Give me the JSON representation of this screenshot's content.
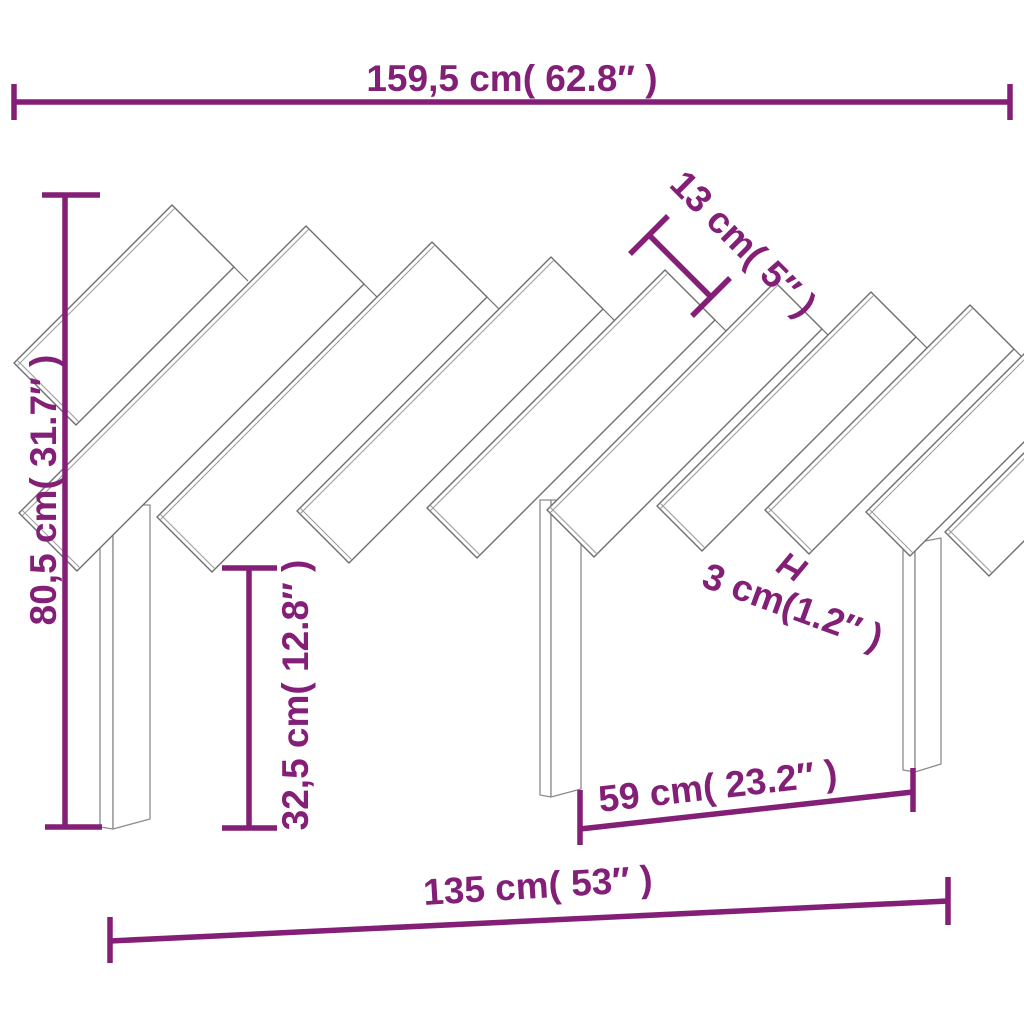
{
  "diagram": {
    "title": "headboard-dimension-drawing",
    "background_color": "#ffffff",
    "accent_color": "#831f76",
    "wood_line_color": "#6e6e70",
    "dimensions": {
      "total_width": "159,5 cm( 62.8″ )",
      "total_height": "80,5 cm( 31.7″ )",
      "slat_width": "13 cm( 5″ )",
      "leg_height": "32,5 cm( 12.8″ )",
      "slat_gap": "3 cm(1.2″ )",
      "leg_spacing": "59 cm( 23.2″ )",
      "base_width": "135 cm( 53″ )"
    }
  }
}
